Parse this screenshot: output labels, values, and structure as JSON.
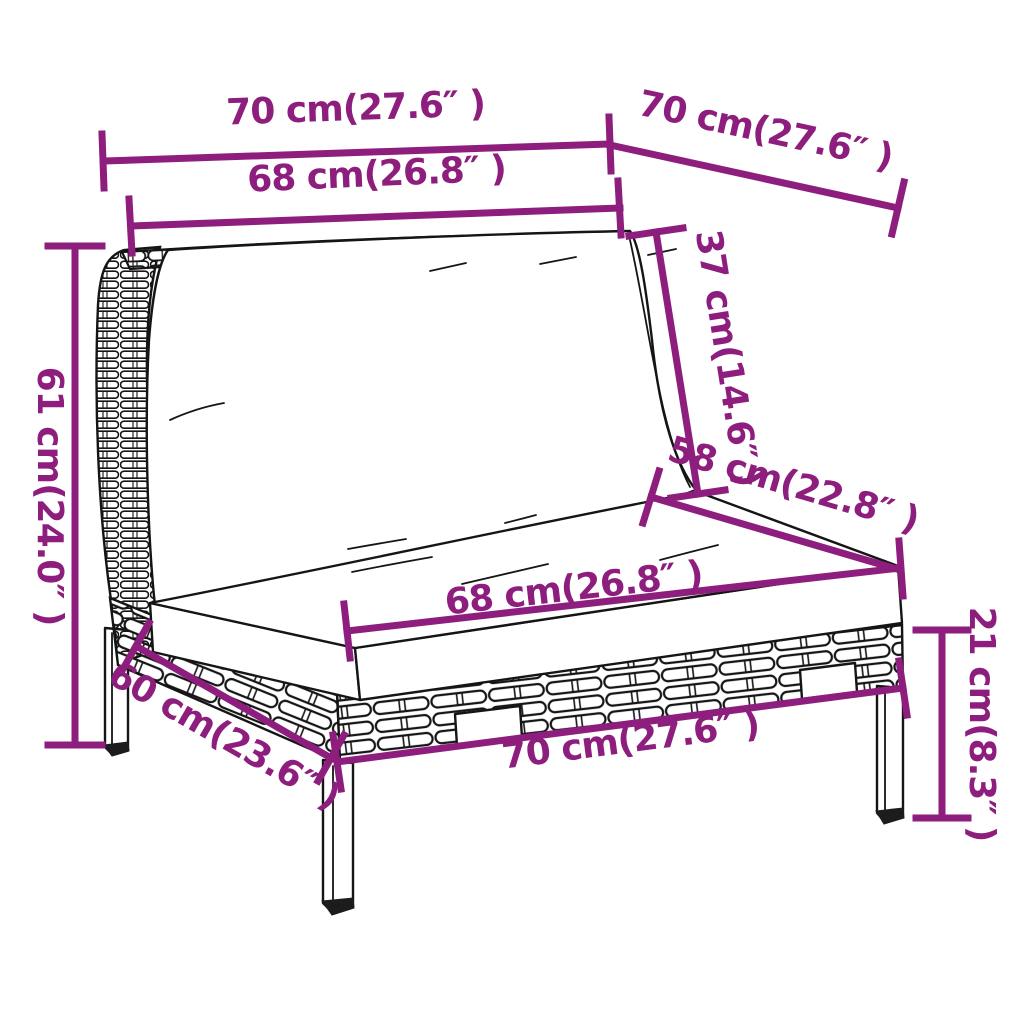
{
  "diagram": {
    "title": "rattan-sofa-section-dimension-diagram",
    "accent_color": "#8e1e7d",
    "line_art_color": "#151515",
    "background_color": "#ffffff",
    "dimensions": [
      {
        "name": "top-width",
        "label": "70 cm(27.6″ )"
      },
      {
        "name": "top-depth",
        "label": "70 cm(27.6″ )"
      },
      {
        "name": "back-cushion-width",
        "label": "68 cm(26.8″ )"
      },
      {
        "name": "back-cushion-height",
        "label": "37 cm(14.6″ )"
      },
      {
        "name": "overall-height",
        "label": "61 cm(24.0″ )"
      },
      {
        "name": "seat-depth",
        "label": "58 cm(22.8″ )"
      },
      {
        "name": "seat-cushion-width",
        "label": "68 cm(26.8″ )"
      },
      {
        "name": "base-depth",
        "label": "60 cm(23.6″ )"
      },
      {
        "name": "base-width",
        "label": "70 cm(27.6″ )"
      },
      {
        "name": "seat-height",
        "label": "21 cm(8.3″ )"
      }
    ]
  }
}
